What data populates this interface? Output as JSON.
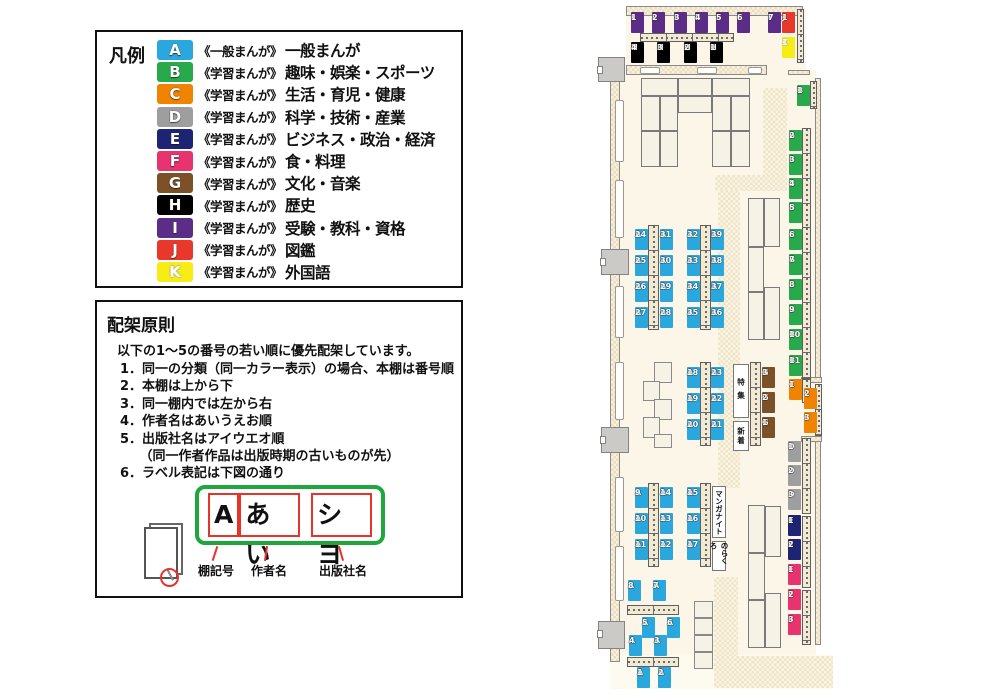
{
  "legend": {
    "title": "凡例",
    "items": [
      {
        "code": "A",
        "color": "#2AA7DC",
        "series": "《一般まんが》",
        "label": "一般まんが"
      },
      {
        "code": "B",
        "color": "#28A94C",
        "series": "《学習まんが》",
        "label": "趣味・娯楽・スポーツ"
      },
      {
        "code": "C",
        "color": "#F08300",
        "series": "《学習まんが》",
        "label": "生活・育児・健康"
      },
      {
        "code": "D",
        "color": "#9E9E9F",
        "series": "《学習まんが》",
        "label": "科学・技術・産業"
      },
      {
        "code": "E",
        "color": "#1D2473",
        "series": "《学習まんが》",
        "label": "ビジネス・政治・経済"
      },
      {
        "code": "F",
        "color": "#E7336E",
        "series": "《学習まんが》",
        "label": "食・料理"
      },
      {
        "code": "G",
        "color": "#7D5128",
        "series": "《学習まんが》",
        "label": "文化・音楽"
      },
      {
        "code": "H",
        "color": "#000000",
        "series": "《学習まんが》",
        "label": "歴史"
      },
      {
        "code": "I",
        "color": "#5B2D86",
        "series": "《学習まんが》",
        "label": "受験・教科・資格"
      },
      {
        "code": "J",
        "color": "#E8382B",
        "series": "《学習まんが》",
        "label": "図鑑"
      },
      {
        "code": "K",
        "color": "#F7EC13",
        "series": "《学習まんが》",
        "label": "外国語"
      }
    ]
  },
  "principles": {
    "title": "配架原則",
    "intro": "以下の1～5の番号の若い順に優先配架しています。",
    "items": [
      "1．同一の分類（同一カラー表示）の場合、本棚は番号順",
      "2．本棚は上から下",
      "3．同一棚内では左から右",
      "4．作者名はあいうえお順",
      "5．出版社名はアイウエオ順",
      "　　（同一作者作品は出版時期の古いものが先）",
      "6．ラベル表記は下図の通り"
    ],
    "label_example": {
      "parts": [
        "A",
        "あい",
        "シヨ"
      ],
      "captions": [
        "棚記号",
        "作者名",
        "出版社名"
      ]
    }
  },
  "map": {
    "colors": {
      "A": "#2AA7DC",
      "B": "#28A94C",
      "C": "#F08300",
      "D": "#9E9E9F",
      "E": "#1D2473",
      "F": "#E7336E",
      "G": "#7D5128",
      "H": "#000000",
      "I": "#5B2D86",
      "J": "#E8382B",
      "K": "#F7EC13"
    },
    "floors": [
      {
        "x": 626,
        "y": 8,
        "w": 180,
        "h": 68
      },
      {
        "x": 610,
        "y": 70,
        "w": 206,
        "h": 590
      },
      {
        "x": 806,
        "y": 377,
        "w": 16,
        "h": 64
      },
      {
        "x": 610,
        "y": 655,
        "w": 223,
        "h": 34,
        "light": true
      }
    ],
    "walkways": [
      {
        "x": 763,
        "y": 88,
        "w": 24,
        "h": 89
      },
      {
        "x": 715,
        "y": 175,
        "w": 72,
        "h": 16
      },
      {
        "x": 718,
        "y": 190,
        "w": 22,
        "h": 298
      },
      {
        "x": 714,
        "y": 577,
        "w": 24,
        "h": 81
      },
      {
        "x": 714,
        "y": 656,
        "w": 119,
        "h": 32
      }
    ],
    "walls": [
      {
        "x": 626,
        "y": 6,
        "w": 177,
        "h": 10
      },
      {
        "x": 626,
        "y": 65,
        "w": 141,
        "h": 10
      },
      {
        "x": 610,
        "y": 60,
        "w": 10,
        "h": 602
      },
      {
        "x": 815,
        "y": 78,
        "w": 6,
        "h": 300
      },
      {
        "x": 815,
        "y": 438,
        "w": 6,
        "h": 207
      },
      {
        "x": 801,
        "y": 377,
        "w": 21,
        "h": 6
      },
      {
        "x": 801,
        "y": 436,
        "w": 21,
        "h": 6
      },
      {
        "x": 788,
        "y": 70,
        "w": 22,
        "h": 5
      }
    ],
    "windows": [
      {
        "x": 615,
        "y": 100,
        "w": 9,
        "h": 62
      },
      {
        "x": 615,
        "y": 180,
        "w": 9,
        "h": 58
      },
      {
        "x": 615,
        "y": 286,
        "w": 9,
        "h": 52
      },
      {
        "x": 615,
        "y": 362,
        "w": 9,
        "h": 58
      },
      {
        "x": 615,
        "y": 477,
        "w": 9,
        "h": 55
      },
      {
        "x": 615,
        "y": 546,
        "w": 9,
        "h": 55
      },
      {
        "x": 640,
        "y": 67,
        "w": 20,
        "h": 7
      },
      {
        "x": 697,
        "y": 67,
        "w": 20,
        "h": 7
      },
      {
        "x": 748,
        "y": 67,
        "w": 14,
        "h": 7
      }
    ],
    "doors": [
      {
        "x": 598,
        "y": 57,
        "w": 27,
        "h": 25
      },
      {
        "x": 601,
        "y": 249,
        "w": 28,
        "h": 26
      },
      {
        "x": 601,
        "y": 427,
        "w": 28,
        "h": 26
      },
      {
        "x": 598,
        "y": 621,
        "w": 27,
        "h": 28
      }
    ],
    "strips": [
      {
        "x": 640,
        "y": 33,
        "w": 94,
        "h": 9,
        "o": "h"
      },
      {
        "x": 797,
        "y": 9,
        "w": 7,
        "h": 54,
        "o": "v"
      },
      {
        "x": 810,
        "y": 81,
        "w": 7,
        "h": 28,
        "o": "v"
      },
      {
        "x": 648,
        "y": 225,
        "w": 11,
        "h": 105,
        "o": "v"
      },
      {
        "x": 700,
        "y": 225,
        "w": 11,
        "h": 105,
        "o": "v"
      },
      {
        "x": 700,
        "y": 362,
        "w": 11,
        "h": 84,
        "o": "v"
      },
      {
        "x": 750,
        "y": 362,
        "w": 11,
        "h": 84,
        "o": "v"
      },
      {
        "x": 648,
        "y": 483,
        "w": 11,
        "h": 84,
        "o": "v"
      },
      {
        "x": 700,
        "y": 483,
        "w": 11,
        "h": 84,
        "o": "v"
      },
      {
        "x": 802,
        "y": 128,
        "w": 9,
        "h": 100,
        "o": "v"
      },
      {
        "x": 802,
        "y": 227,
        "w": 9,
        "h": 152,
        "o": "v"
      },
      {
        "x": 802,
        "y": 379,
        "w": 9,
        "h": 24,
        "o": "v"
      },
      {
        "x": 815,
        "y": 384,
        "w": 7,
        "h": 52,
        "o": "v"
      },
      {
        "x": 802,
        "y": 438,
        "w": 9,
        "h": 76,
        "o": "v"
      },
      {
        "x": 802,
        "y": 516,
        "w": 9,
        "h": 72,
        "o": "v"
      },
      {
        "x": 802,
        "y": 590,
        "w": 9,
        "h": 55,
        "o": "v"
      },
      {
        "x": 627,
        "y": 605,
        "w": 52,
        "h": 10,
        "o": "h"
      },
      {
        "x": 627,
        "y": 657,
        "w": 52,
        "h": 10,
        "o": "h"
      }
    ],
    "tables": [
      {
        "x": 641,
        "y": 78,
        "w": 37,
        "h": 18
      },
      {
        "x": 678,
        "y": 78,
        "w": 34,
        "h": 18
      },
      {
        "x": 712,
        "y": 78,
        "w": 38,
        "h": 18
      },
      {
        "x": 678,
        "y": 96,
        "w": 34,
        "h": 17
      },
      {
        "x": 641,
        "y": 96,
        "w": 19,
        "h": 35
      },
      {
        "x": 660,
        "y": 96,
        "w": 18,
        "h": 35
      },
      {
        "x": 641,
        "y": 131,
        "w": 19,
        "h": 36
      },
      {
        "x": 660,
        "y": 131,
        "w": 18,
        "h": 36
      },
      {
        "x": 712,
        "y": 96,
        "w": 19,
        "h": 35
      },
      {
        "x": 731,
        "y": 96,
        "w": 19,
        "h": 35
      },
      {
        "x": 712,
        "y": 131,
        "w": 19,
        "h": 36
      },
      {
        "x": 731,
        "y": 131,
        "w": 19,
        "h": 36
      },
      {
        "x": 748,
        "y": 198,
        "w": 16,
        "h": 49
      },
      {
        "x": 748,
        "y": 247,
        "w": 16,
        "h": 45
      },
      {
        "x": 748,
        "y": 292,
        "w": 16,
        "h": 48
      },
      {
        "x": 764,
        "y": 198,
        "w": 16,
        "h": 49
      },
      {
        "x": 764,
        "y": 287,
        "w": 16,
        "h": 53
      },
      {
        "x": 748,
        "y": 505,
        "w": 17,
        "h": 48
      },
      {
        "x": 748,
        "y": 553,
        "w": 17,
        "h": 47
      },
      {
        "x": 748,
        "y": 600,
        "w": 17,
        "h": 48
      },
      {
        "x": 765,
        "y": 506,
        "w": 16,
        "h": 51
      },
      {
        "x": 765,
        "y": 593,
        "w": 16,
        "h": 55
      }
    ],
    "seats": [
      {
        "x": 654,
        "y": 362,
        "w": 18,
        "h": 21
      },
      {
        "x": 643,
        "y": 381,
        "w": 17,
        "h": 20
      },
      {
        "x": 654,
        "y": 399,
        "w": 18,
        "h": 21
      },
      {
        "x": 643,
        "y": 417,
        "w": 17,
        "h": 21
      },
      {
        "x": 654,
        "y": 434,
        "w": 18,
        "h": 14
      },
      {
        "x": 694,
        "y": 601,
        "w": 19,
        "h": 17
      },
      {
        "x": 694,
        "y": 618,
        "w": 19,
        "h": 17
      },
      {
        "x": 694,
        "y": 635,
        "w": 19,
        "h": 17
      },
      {
        "x": 694,
        "y": 652,
        "w": 19,
        "h": 17
      }
    ],
    "text_boxes": [
      {
        "text": "特集",
        "x": 733,
        "y": 364,
        "w": 16,
        "h": 54,
        "ls": 6
      },
      {
        "text": "新着",
        "x": 733,
        "y": 421,
        "w": 16,
        "h": 30,
        "ls": 2
      },
      {
        "text": "マンガナイト",
        "x": 712,
        "y": 486,
        "w": 14,
        "h": 52,
        "ls": 0
      },
      {
        "text": "のらくろ",
        "x": 712,
        "y": 541,
        "w": 14,
        "h": 30,
        "ls": 0
      }
    ],
    "shelf_labels": [
      {
        "id": "I1",
        "x": 631,
        "y": 12
      },
      {
        "id": "I2",
        "x": 652,
        "y": 12
      },
      {
        "id": "I3",
        "x": 674,
        "y": 12
      },
      {
        "id": "I4",
        "x": 695,
        "y": 12
      },
      {
        "id": "I5",
        "x": 716,
        "y": 12
      },
      {
        "id": "I6",
        "x": 737,
        "y": 12
      },
      {
        "id": "I7",
        "x": 768,
        "y": 12
      },
      {
        "id": "J1",
        "x": 782,
        "y": 12
      },
      {
        "id": "K1",
        "x": 782,
        "y": 37
      },
      {
        "id": "H4",
        "x": 631,
        "y": 42
      },
      {
        "id": "H3",
        "x": 657,
        "y": 42
      },
      {
        "id": "H2",
        "x": 684,
        "y": 42
      },
      {
        "id": "H1",
        "x": 710,
        "y": 42
      },
      {
        "id": "B1",
        "x": 797,
        "y": 85
      },
      {
        "id": "B2",
        "x": 789,
        "y": 130
      },
      {
        "id": "B3",
        "x": 789,
        "y": 154
      },
      {
        "id": "B4",
        "x": 789,
        "y": 178
      },
      {
        "id": "B5",
        "x": 789,
        "y": 202
      },
      {
        "id": "B6",
        "x": 789,
        "y": 229
      },
      {
        "id": "B7",
        "x": 789,
        "y": 254
      },
      {
        "id": "B8",
        "x": 789,
        "y": 279
      },
      {
        "id": "B9",
        "x": 789,
        "y": 304
      },
      {
        "id": "B10",
        "x": 789,
        "y": 329
      },
      {
        "id": "B11",
        "x": 789,
        "y": 355
      },
      {
        "id": "C1",
        "x": 789,
        "y": 379
      },
      {
        "id": "C2",
        "x": 804,
        "y": 388
      },
      {
        "id": "C3",
        "x": 804,
        "y": 412
      },
      {
        "id": "D1",
        "x": 788,
        "y": 441
      },
      {
        "id": "D2",
        "x": 788,
        "y": 465
      },
      {
        "id": "D3",
        "x": 788,
        "y": 489
      },
      {
        "id": "E1",
        "x": 788,
        "y": 515
      },
      {
        "id": "E2",
        "x": 788,
        "y": 539
      },
      {
        "id": "F1",
        "x": 788,
        "y": 564
      },
      {
        "id": "F2",
        "x": 788,
        "y": 589
      },
      {
        "id": "F3",
        "x": 788,
        "y": 614
      },
      {
        "id": "G3",
        "x": 762,
        "y": 367
      },
      {
        "id": "G2",
        "x": 762,
        "y": 392
      },
      {
        "id": "G1",
        "x": 762,
        "y": 417
      },
      {
        "id": "A24",
        "x": 635,
        "y": 229
      },
      {
        "id": "A25",
        "x": 635,
        "y": 255
      },
      {
        "id": "A26",
        "x": 635,
        "y": 281
      },
      {
        "id": "A27",
        "x": 635,
        "y": 307
      },
      {
        "id": "A31",
        "x": 660,
        "y": 229
      },
      {
        "id": "A30",
        "x": 660,
        "y": 255
      },
      {
        "id": "A29",
        "x": 660,
        "y": 281
      },
      {
        "id": "A28",
        "x": 660,
        "y": 307
      },
      {
        "id": "A32",
        "x": 687,
        "y": 229
      },
      {
        "id": "A33",
        "x": 687,
        "y": 255
      },
      {
        "id": "A34",
        "x": 687,
        "y": 281
      },
      {
        "id": "A35",
        "x": 687,
        "y": 307
      },
      {
        "id": "A39",
        "x": 711,
        "y": 229
      },
      {
        "id": "A38",
        "x": 711,
        "y": 255
      },
      {
        "id": "A37",
        "x": 711,
        "y": 281
      },
      {
        "id": "A36",
        "x": 711,
        "y": 307
      },
      {
        "id": "A18",
        "x": 687,
        "y": 367
      },
      {
        "id": "A19",
        "x": 687,
        "y": 393
      },
      {
        "id": "A20",
        "x": 687,
        "y": 419
      },
      {
        "id": "A23",
        "x": 711,
        "y": 367
      },
      {
        "id": "A22",
        "x": 711,
        "y": 393
      },
      {
        "id": "A21",
        "x": 711,
        "y": 419
      },
      {
        "id": "A9",
        "x": 635,
        "y": 487
      },
      {
        "id": "A10",
        "x": 635,
        "y": 513
      },
      {
        "id": "A11",
        "x": 635,
        "y": 539
      },
      {
        "id": "A14",
        "x": 660,
        "y": 487
      },
      {
        "id": "A13",
        "x": 660,
        "y": 513
      },
      {
        "id": "A12",
        "x": 660,
        "y": 539
      },
      {
        "id": "A15",
        "x": 687,
        "y": 487
      },
      {
        "id": "A16",
        "x": 687,
        "y": 513
      },
      {
        "id": "A17",
        "x": 687,
        "y": 539
      },
      {
        "id": "A8",
        "x": 628,
        "y": 580
      },
      {
        "id": "A7",
        "x": 653,
        "y": 580
      },
      {
        "id": "A5",
        "x": 642,
        "y": 617
      },
      {
        "id": "A6",
        "x": 667,
        "y": 617
      },
      {
        "id": "A4",
        "x": 629,
        "y": 635
      },
      {
        "id": "A3",
        "x": 654,
        "y": 635
      },
      {
        "id": "A1",
        "x": 637,
        "y": 667
      },
      {
        "id": "A2",
        "x": 658,
        "y": 667
      }
    ]
  }
}
